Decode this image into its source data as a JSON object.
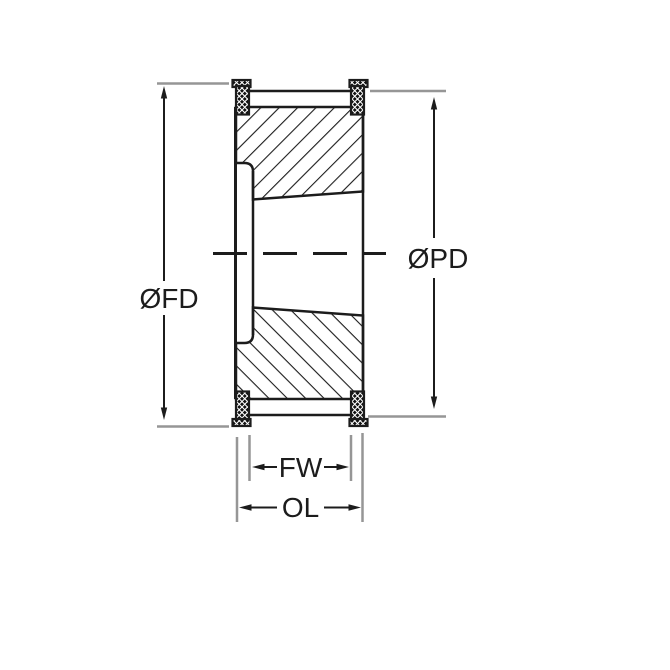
{
  "drawing": {
    "type": "technical-cross-section",
    "subject": "timing-belt-pulley-with-taper-bush",
    "labels": {
      "flange_diameter": "ØFD",
      "pitch_diameter": "ØPD",
      "face_width": "FW",
      "overall_length": "OL"
    }
  },
  "colors": {
    "line": "#1c1c1c",
    "extension_line": "#969696",
    "background": "#ffffff"
  }
}
